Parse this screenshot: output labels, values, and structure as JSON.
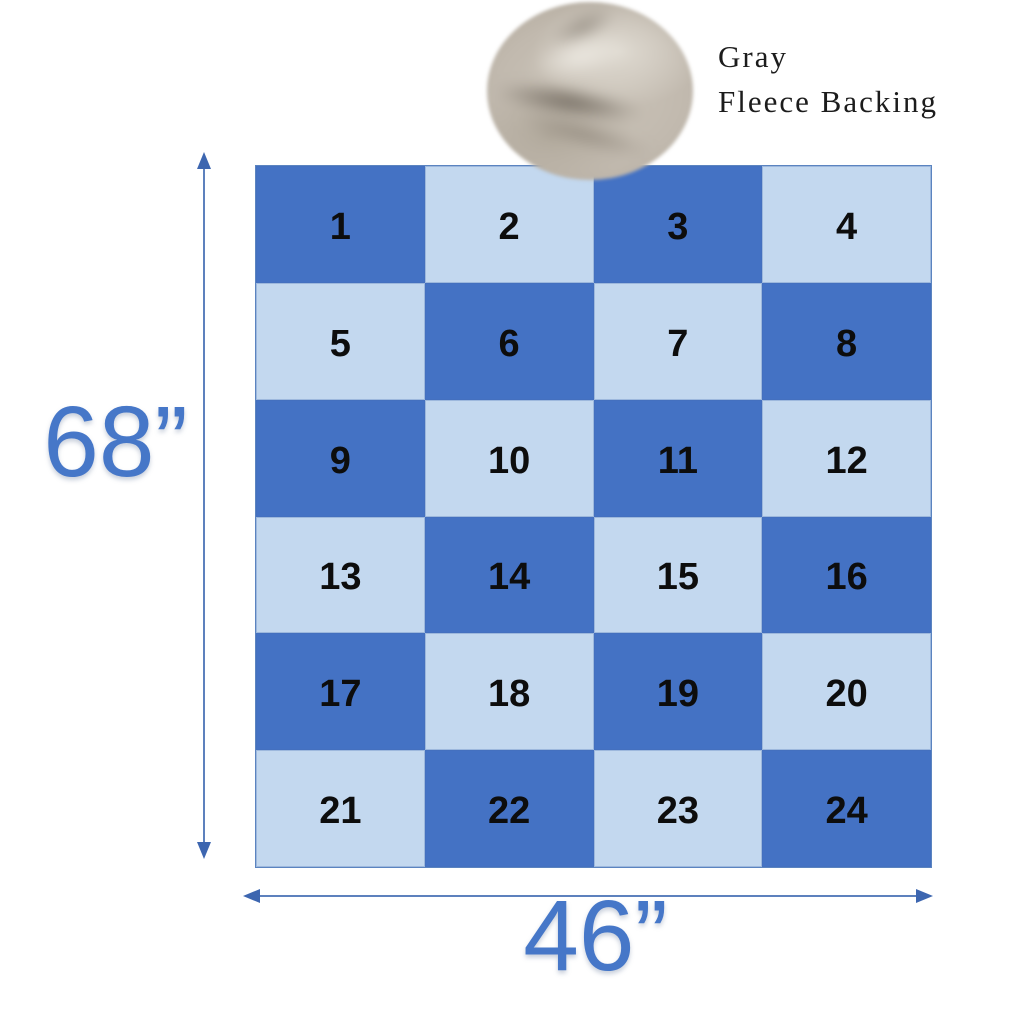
{
  "page": {
    "background": "#ffffff"
  },
  "backing": {
    "label_line1": "Gray",
    "label_line2": "Fleece Backing",
    "swatch": "gray-fleece-fabric-photo"
  },
  "quilt": {
    "rows": 6,
    "cols": 4,
    "colors": {
      "dark": "#4472C4",
      "light": "#C3D8EF",
      "border": "#5b84c0",
      "number": "#0d0d0d"
    },
    "cells": [
      {
        "n": "1",
        "tone": "dark"
      },
      {
        "n": "2",
        "tone": "light"
      },
      {
        "n": "3",
        "tone": "dark"
      },
      {
        "n": "4",
        "tone": "light"
      },
      {
        "n": "5",
        "tone": "light"
      },
      {
        "n": "6",
        "tone": "dark"
      },
      {
        "n": "7",
        "tone": "light"
      },
      {
        "n": "8",
        "tone": "dark"
      },
      {
        "n": "9",
        "tone": "dark"
      },
      {
        "n": "10",
        "tone": "light"
      },
      {
        "n": "11",
        "tone": "dark"
      },
      {
        "n": "12",
        "tone": "light"
      },
      {
        "n": "13",
        "tone": "light"
      },
      {
        "n": "14",
        "tone": "dark"
      },
      {
        "n": "15",
        "tone": "light"
      },
      {
        "n": "16",
        "tone": "dark"
      },
      {
        "n": "17",
        "tone": "dark"
      },
      {
        "n": "18",
        "tone": "light"
      },
      {
        "n": "19",
        "tone": "dark"
      },
      {
        "n": "20",
        "tone": "light"
      },
      {
        "n": "21",
        "tone": "light"
      },
      {
        "n": "22",
        "tone": "dark"
      },
      {
        "n": "23",
        "tone": "light"
      },
      {
        "n": "24",
        "tone": "dark"
      }
    ]
  },
  "dimensions": {
    "height": {
      "label": "68”"
    },
    "width": {
      "label": "46”"
    },
    "arrow_color": "#5d81bd",
    "arrow_head_color": "#3d66b0",
    "label_color": "#4677C8"
  }
}
